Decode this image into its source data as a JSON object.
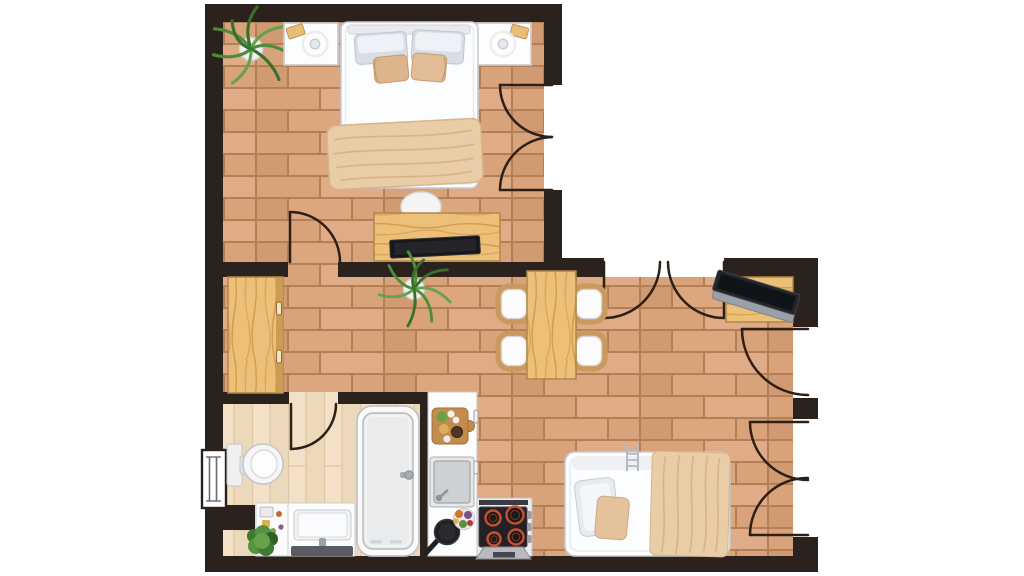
{
  "app": {
    "type": "floor-plan",
    "view": "top-down",
    "style": "illustrated 2D apartment plan",
    "background": "#ffffff"
  },
  "visible_text": [],
  "colors": {
    "background": "#ffffff",
    "wall": "#2b221d",
    "door_line": "#2e2014",
    "grout": "#b57f55",
    "brick_a": "#d8a37b",
    "brick_b": "#dfac87",
    "brick_c": "#d09a72",
    "brick_d": "#dca77f",
    "plank_a": "#f2e1c6",
    "plank_b": "#ecd8ba",
    "plank_line": "#dfc5a1",
    "wood_base": "#ecc078",
    "wood_grain": "#d29c4d",
    "wood_edge": "#b2874a",
    "white_furniture": "#fcfdfe",
    "furniture_stroke": "#c7cacf",
    "pillow_gray": "#d9dde6",
    "textile_beige": "#e9cda6",
    "textile_stroke": "#d6b48c",
    "plant_green": "#4f8c3a",
    "plant_dark": "#39702b",
    "stove_top": "#232127",
    "burner_ring": "#c2502c",
    "metal": "#9aa0a8",
    "mat_dark": "#5a5c61"
  },
  "rooms": [
    {
      "id": "bedroom",
      "position": "top-left",
      "floor": "brick-tile",
      "items": [
        "double-bed",
        "headboard",
        "pillows-x2",
        "cushions-x2",
        "blanket",
        "nightstand-left",
        "nightstand-right",
        "table-lamp-x2",
        "book-x2",
        "dresser",
        "tv",
        "bedside-lamp",
        "potted-plant"
      ]
    },
    {
      "id": "hallway",
      "position": "center-left",
      "floor": "brick-tile",
      "items": [
        "wardrobe",
        "potted-plant"
      ]
    },
    {
      "id": "living-dining",
      "position": "right",
      "floor": "brick-tile",
      "items": [
        "dining-table",
        "dining-chair-x4",
        "desk",
        "laptop",
        "sofa-bed",
        "pillow",
        "cushion",
        "throw-blanket",
        "ladder"
      ]
    },
    {
      "id": "kitchen",
      "position": "bottom-center",
      "floor": "brick-tile",
      "items": [
        "counter",
        "cutting-board-with-food",
        "sink",
        "faucet",
        "frying-pan",
        "vegetable-bowl",
        "stove-4-burner",
        "control-knobs-x3",
        "extractor-hood",
        "cabinet-handles-x2"
      ]
    },
    {
      "id": "bathroom",
      "position": "bottom-left",
      "floor": "wood-plank",
      "items": [
        "toilet",
        "bathtub",
        "tub-faucet",
        "vanity-sink",
        "bath-mat",
        "storage-cabinet",
        "potted-plant",
        "window"
      ]
    }
  ],
  "openings": {
    "windows": [
      {
        "wall": "west",
        "room": "bathroom"
      }
    ],
    "doors": [
      {
        "type": "single",
        "room": "bedroom",
        "wall": "south"
      },
      {
        "type": "french-double",
        "room": "bedroom",
        "wall": "east"
      },
      {
        "type": "double",
        "room": "living-dining",
        "wall": "north"
      },
      {
        "type": "single",
        "room": "living-dining",
        "wall": "east"
      },
      {
        "type": "french-double",
        "room": "living-dining",
        "wall": "east"
      },
      {
        "type": "single",
        "room": "bathroom",
        "wall": "north"
      }
    ]
  }
}
